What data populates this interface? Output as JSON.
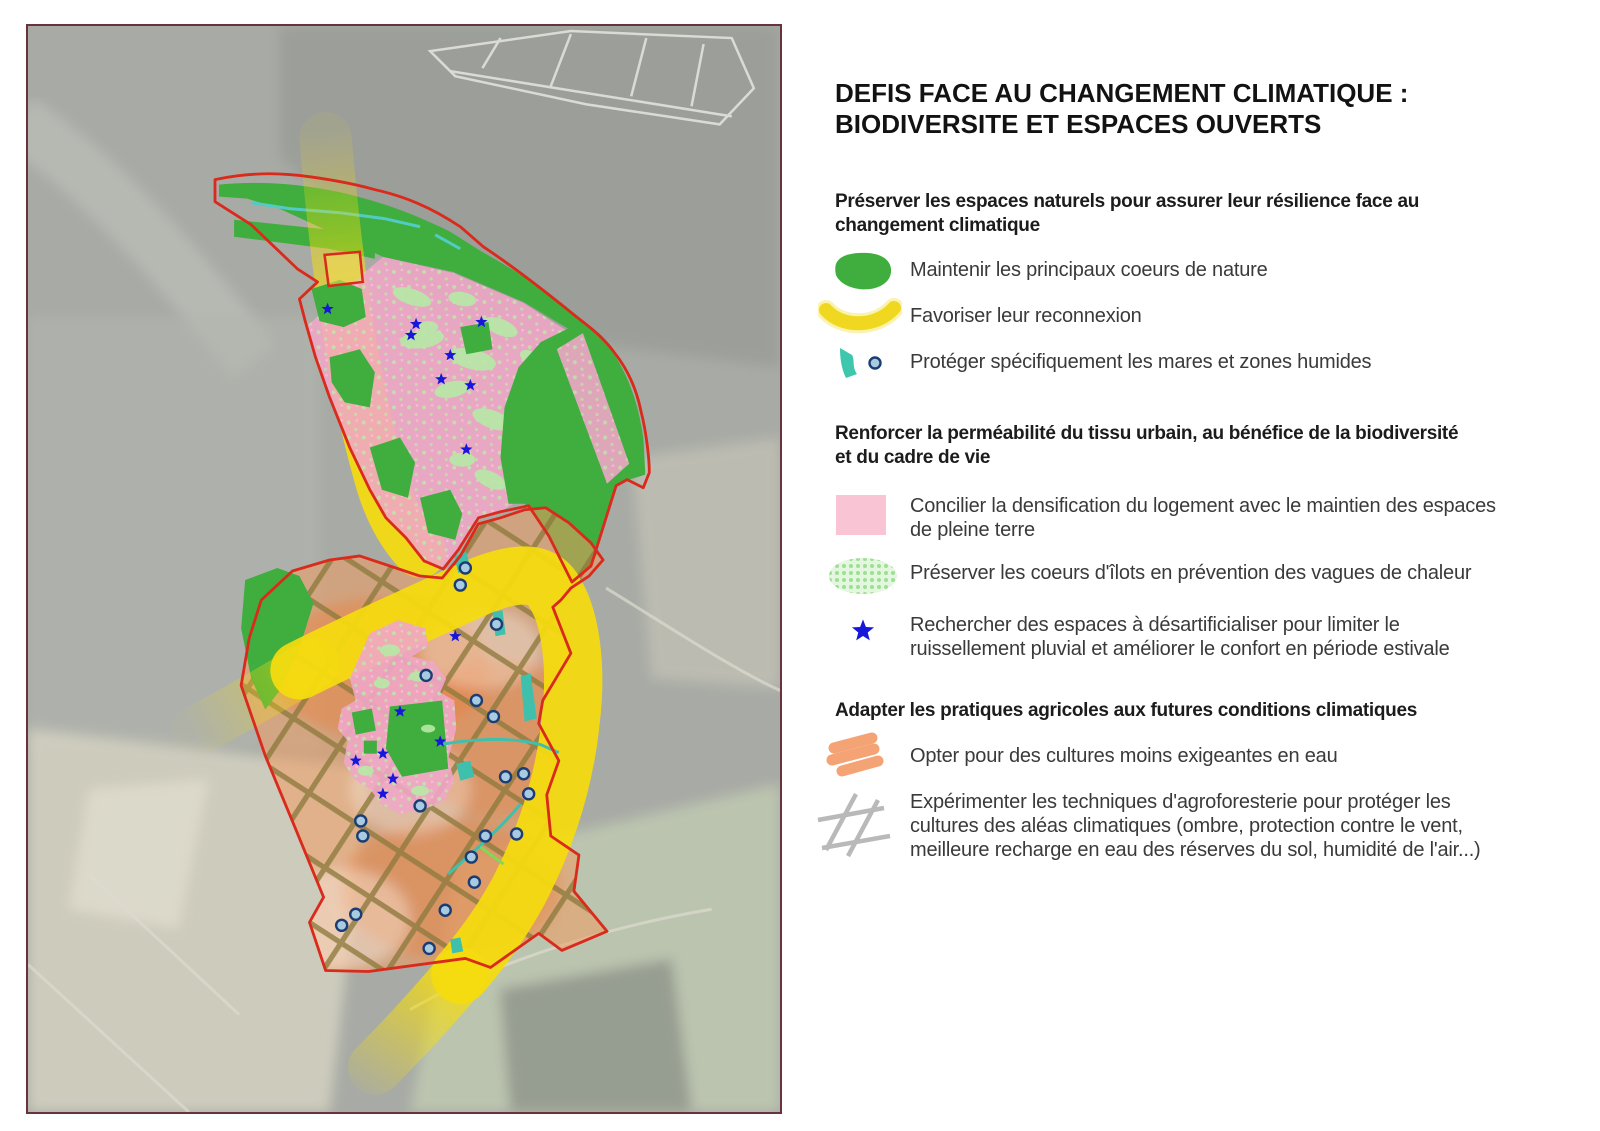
{
  "title": "DEFIS FACE AU CHANGEMENT CLIMATIQUE :\nBIODIVERSITE ET ESPACES OUVERTS",
  "legend": {
    "sections": [
      {
        "heading": "Préserver les espaces naturels pour assurer leur résilience face au\nchangement climatique",
        "items": [
          {
            "icon": "nature-core-icon",
            "label": "Maintenir les principaux coeurs de nature"
          },
          {
            "icon": "reconnection-corridor-icon",
            "label": "Favoriser leur reconnexion"
          },
          {
            "icon": "wetland-pond-icon",
            "label": "Protéger spécifiquement les mares et zones humides"
          }
        ]
      },
      {
        "heading": "Renforcer la perméabilité du tissu urbain, au bénéfice de la biodiversité\net du cadre de vie",
        "items": [
          {
            "icon": "pink-density-icon",
            "label": "Concilier la densification du logement avec le maintien des espaces\nde pleine terre"
          },
          {
            "icon": "heat-island-core-icon",
            "label": "Préserver les coeurs d'îlots en prévention des vagues de chaleur"
          },
          {
            "icon": "desartificialise-star-icon",
            "label": "Rechercher des espaces à désartificialiser pour limiter le\nruissellement pluvial et améliorer le confort en période estivale"
          }
        ]
      },
      {
        "heading": "Adapter les pratiques agricoles aux futures conditions climatiques",
        "items": [
          {
            "icon": "low-water-crops-icon",
            "label": "Opter pour des cultures moins exigeantes en eau"
          },
          {
            "icon": "agroforestry-hatch-icon",
            "label": "Expérimenter les techniques d'agroforesterie pour protéger les\ncultures des aléas climatiques (ombre, protection contre le vent,\nmeilleure recharge en eau des réserves du sol, humidité de l'air...)"
          }
        ]
      }
    ]
  },
  "map": {
    "colors": {
      "boundary_red": "#da2a1c",
      "nature_green": "#3fae3e",
      "corridor_yellow": "#f5dc0e",
      "urban_pink": "#f0a6c6",
      "heat_core_green": "#b7e9a6",
      "star_blue": "#1717dc",
      "agriculture_orange": "#f09c63",
      "hatch_olive": "#8e7b3e",
      "wetland_teal": "#3fc0ac",
      "pond_dot_fill": "#a9cbe2",
      "pond_dot_ring": "#1c3d74",
      "frame_maroon": "#6a323c"
    }
  }
}
